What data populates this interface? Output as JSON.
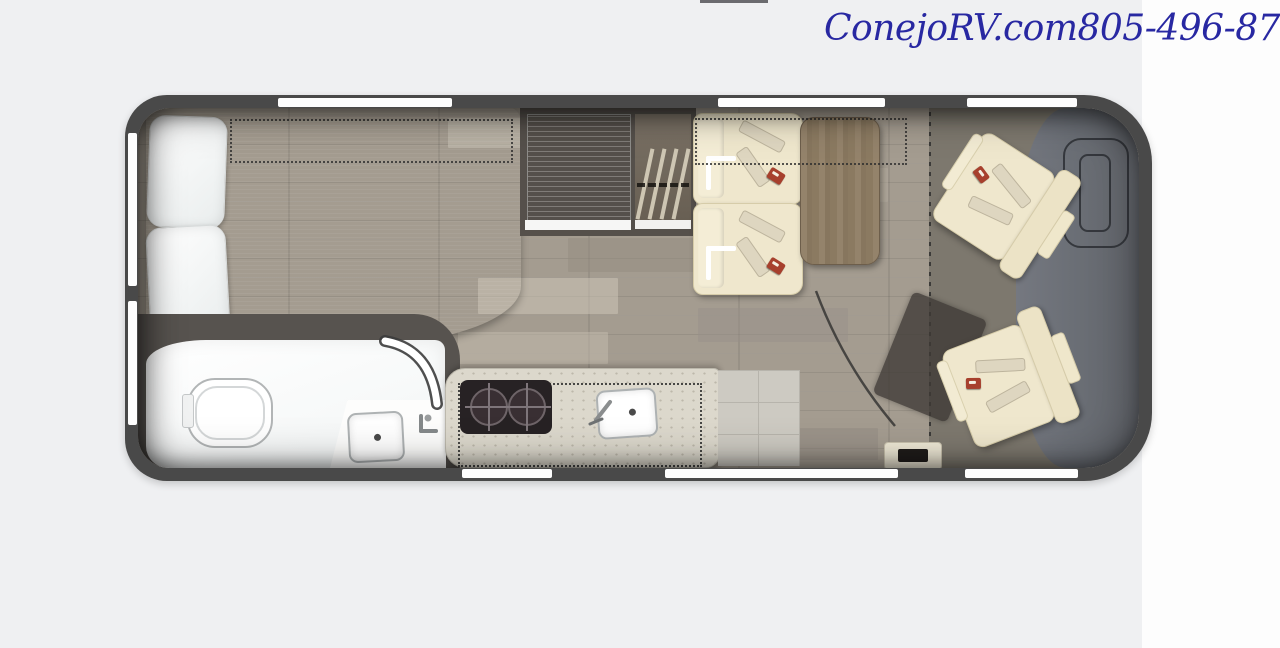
{
  "header": {
    "site": "ConejoRV.com",
    "phone": "805-496-8700"
  },
  "colors": {
    "bg": "#eff0f2",
    "panel": "#fdfdfd",
    "brand": "#2828a2",
    "wall": "#494949",
    "window": "#fdfdfd",
    "floor": "#a49c90",
    "cab_floor": "#7d786e",
    "dash": "#6b6f76",
    "mattress": "#8e9497",
    "pillow": "#e9eded",
    "cream": "#efe7cd",
    "cream_trim": "#d6cca9",
    "belt": "#ded6c0",
    "buckle": "#a7402d",
    "table": "#8b7a61",
    "table_trim": "#6d5e4b",
    "counter": "#dcd8cc",
    "stove": "#272224",
    "tile": "#cdcac2",
    "cabinet": "#55504b",
    "closet": "#675e52",
    "bath": "#f2f5f5",
    "fixture_line": "#b2b5b6",
    "dot": "#2e2e2e",
    "shadow_rect": "rgba(62,57,52,0.78)"
  },
  "features": [
    "bed",
    "pillows",
    "bed-extension-dotted-outline",
    "wardrobe",
    "refrigerator",
    "dinette-belted-seats",
    "dinette-table",
    "overhead-cabinet-dotted-outline",
    "kitchen-counter",
    "two-burner-stove",
    "kitchen-sink",
    "bathroom-toilet",
    "bathroom-sink",
    "bathroom-door-arc",
    "entry-step",
    "driver-swivel-chair",
    "passenger-swivel-chair",
    "steering-wheel",
    "cab-partition-dotted-line",
    "windows",
    "sliding-door-opening"
  ]
}
